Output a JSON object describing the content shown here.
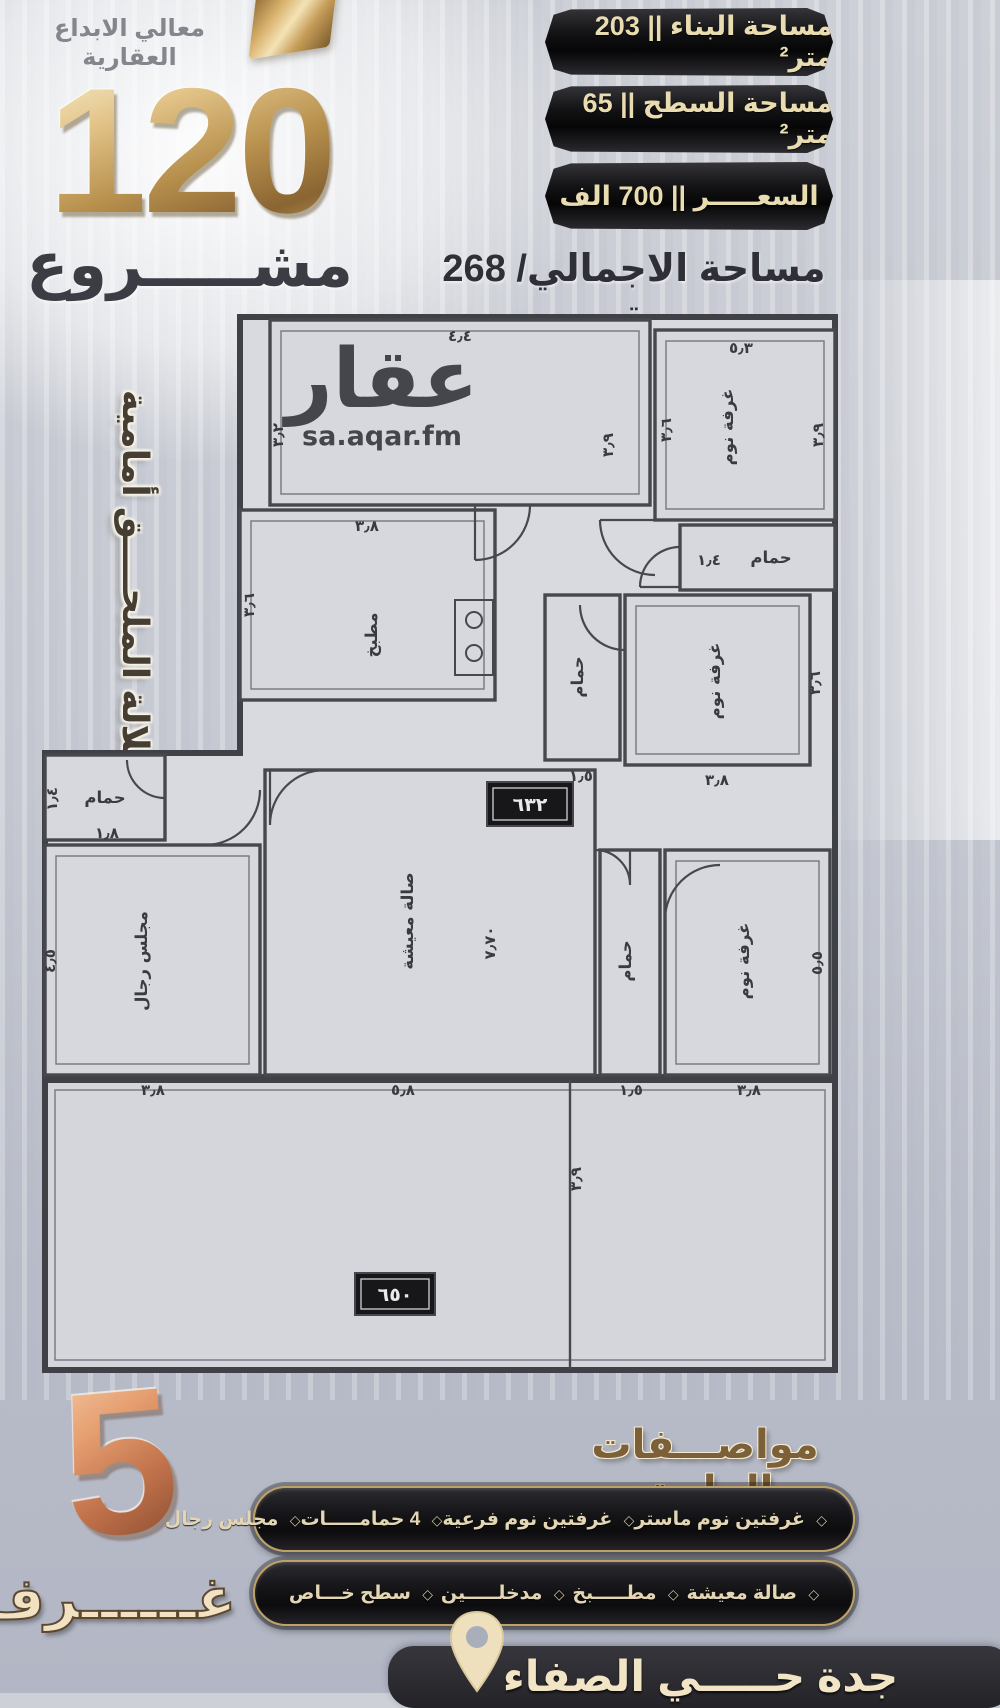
{
  "colors": {
    "gold": "#c9a468",
    "copper": "#cf8a5e",
    "ribbon_black": "#151517",
    "ribbon_text": "#e9dcb0",
    "wall": "#46484e",
    "accent_brown": "#7c6038"
  },
  "header": {
    "company": "معالي الابداع العقارية",
    "project_number": "120",
    "project_word": "مشـــــروع",
    "area_badges": [
      {
        "label": "مساحة البناء || 203 متر²"
      },
      {
        "label": "مساحة السطح || 65 متر²"
      },
      {
        "label": "السعـــــر || 700 الف"
      }
    ],
    "total_area": "مساحة الاجمالي/ 268 متر"
  },
  "side_note": "اطلالة الملحــــق أمامية",
  "watermark": {
    "logo": "عقار",
    "site": "sa.aqar.fm"
  },
  "floorplan": {
    "labels": [
      "غرفة نوم",
      "حمام",
      "مطبخ",
      "حمام",
      "غرفة نوم",
      "حمام",
      "مجلس رجال",
      "صالة معيشة",
      "حمام",
      "غرفة نوم"
    ],
    "dims": [
      "٤٫٤",
      "٣٫٢",
      "٣٫٩",
      "٥٫٣",
      "٣٫٦",
      "٣٫٩",
      "١٫٤",
      "٣٫٨",
      "٣٫٦",
      "١٫٥",
      "٣٫٨",
      "٣٫٦",
      "١٫٤",
      "١٫٨",
      "٤٫٥",
      "٧٫٧٠",
      "٣٫٨",
      "٥٫٨",
      "١٫٥",
      "٣٫٨",
      "٥٫٥",
      "٣٫٩"
    ],
    "area_tags": [
      "٦٣٢",
      "٦٥٠"
    ]
  },
  "footer": {
    "rooms_count": "5",
    "rooms_word": "غــــــرف",
    "specs_title": "مواصـــفات الملحق",
    "separator": "◇",
    "spec_lines": [
      {
        "items": [
          "غرفتين نوم ماستر",
          "غرفتين نوم فرعية",
          "4 حمامـــــات",
          "مجلس رجال"
        ]
      },
      {
        "items": [
          "صالة معيشة",
          "مطـــــبخ",
          "مدخلـــــين",
          "سطح خـــاص"
        ]
      }
    ],
    "location": "جدة حـــــي الصفاء"
  }
}
